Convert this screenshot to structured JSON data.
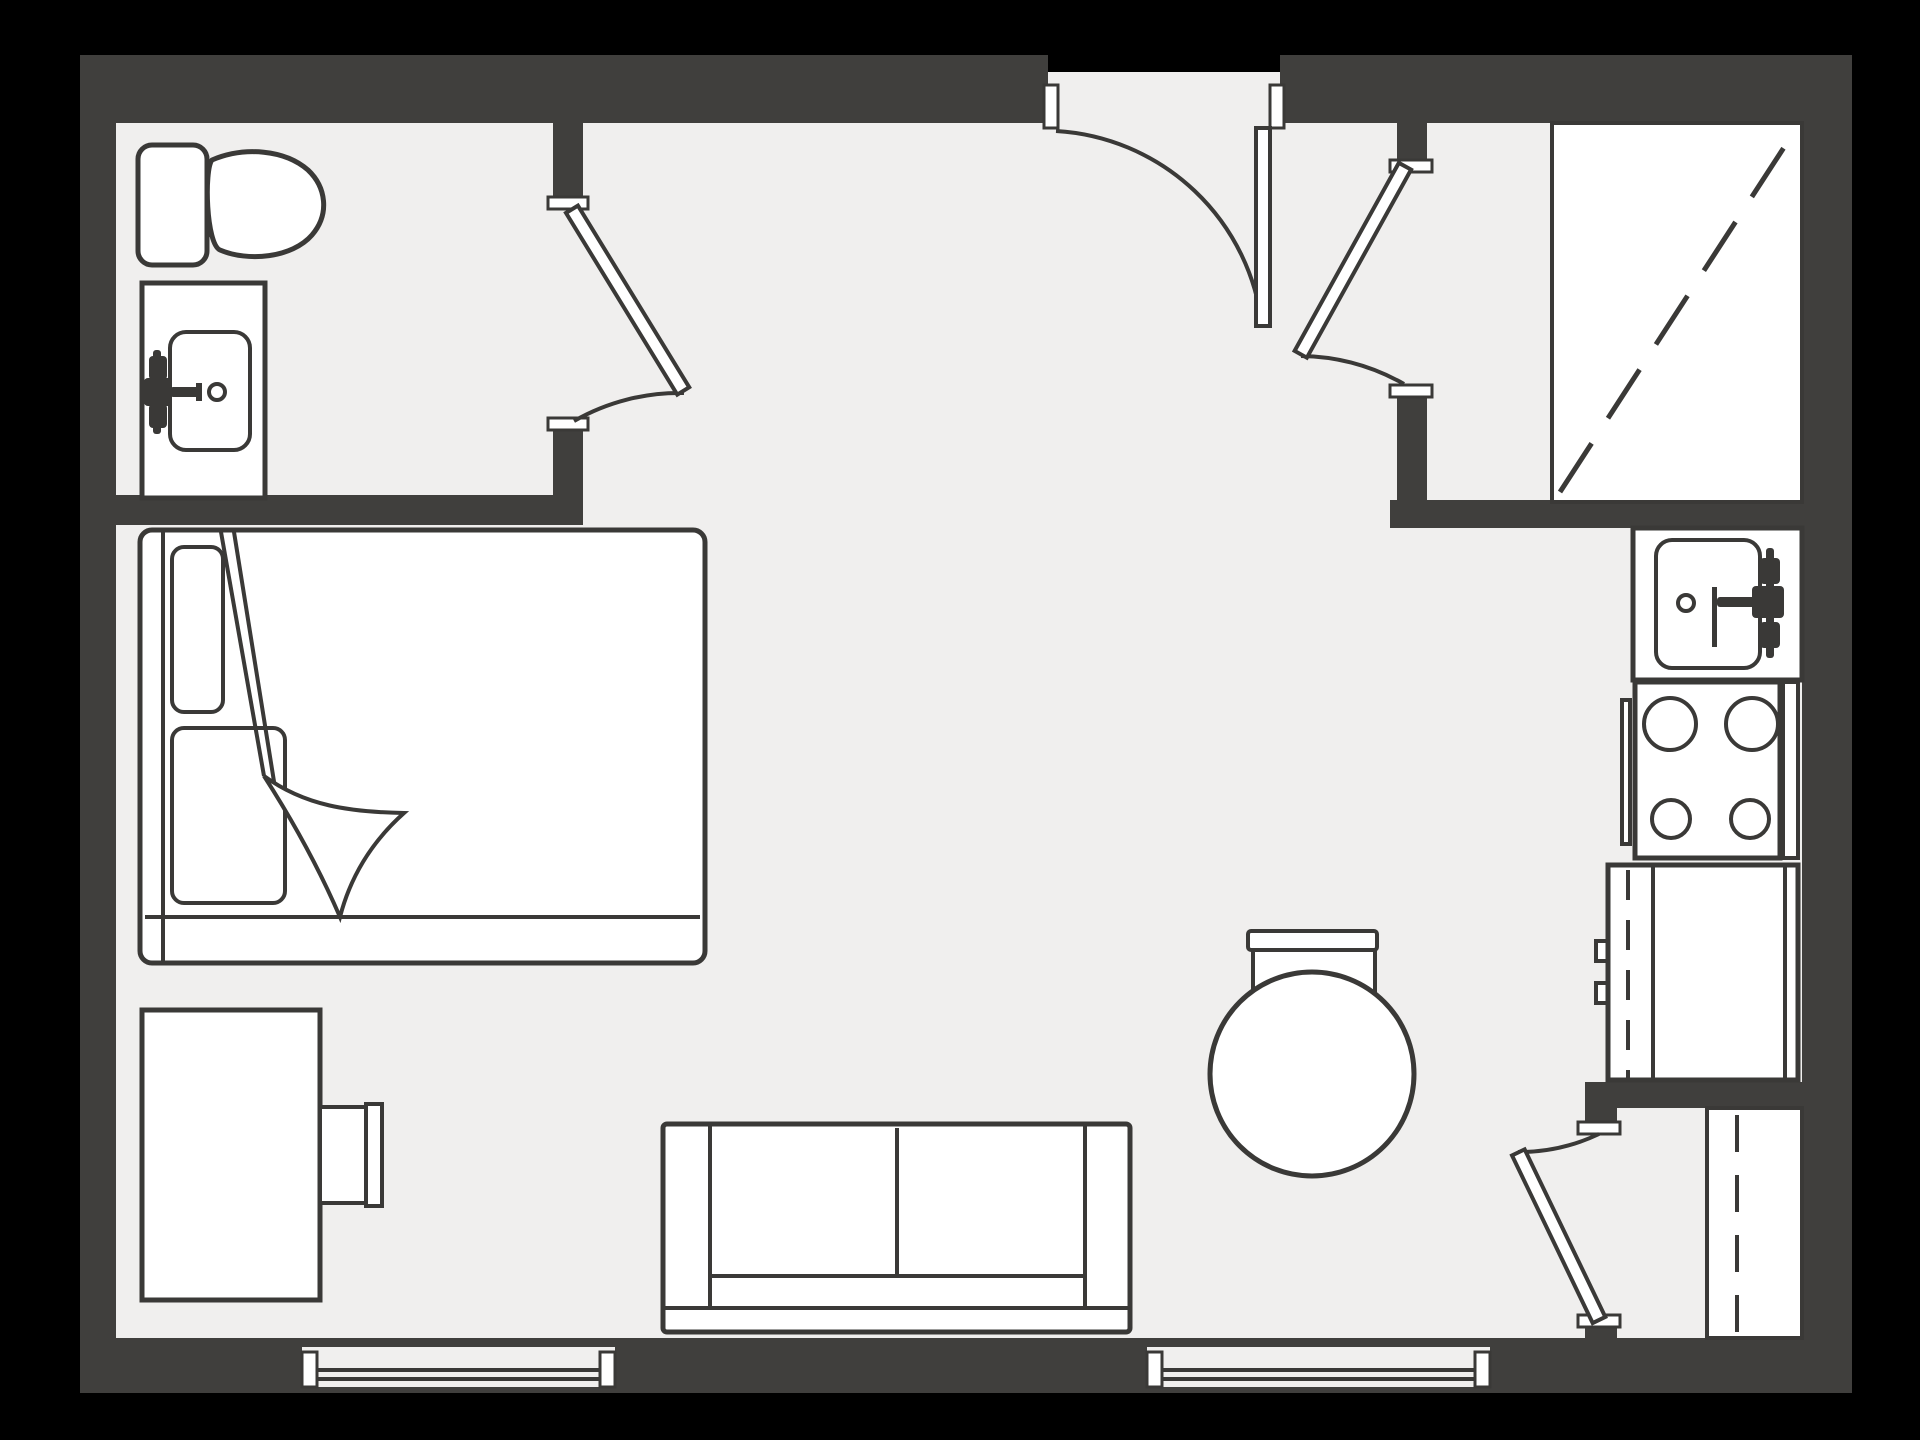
{
  "title": "Studio Apartment Floor Plan",
  "canvas": {
    "width": 1920,
    "height": 1440
  },
  "colors": {
    "background": "#000000",
    "wall": "#403f3d",
    "floor": "#f0efee",
    "fixture": "#ffffff",
    "line": "#3a3937"
  },
  "rooms": [
    {
      "name": "bathroom",
      "position": "top-left"
    },
    {
      "name": "entry-vestibule",
      "position": "top-center"
    },
    {
      "name": "shower-room",
      "position": "top-right"
    },
    {
      "name": "main-living-area",
      "position": "center"
    },
    {
      "name": "kitchen-run",
      "position": "right"
    },
    {
      "name": "closet",
      "position": "bottom-right"
    }
  ],
  "fixtures": [
    "toilet",
    "bathroom-sink-vanity",
    "bathroom-door",
    "entry-door",
    "shower-room-door",
    "shower-pan",
    "kitchen-sink-counter",
    "stove-four-burners",
    "refrigerator",
    "closet-door",
    "closet-rod",
    "bed-with-pillows-and-blanket",
    "desk",
    "desk-chair",
    "sofa",
    "round-dining-table",
    "dining-chair",
    "window-left",
    "window-right"
  ],
  "window_count": 2,
  "door_count": 4,
  "burner_count": 4
}
